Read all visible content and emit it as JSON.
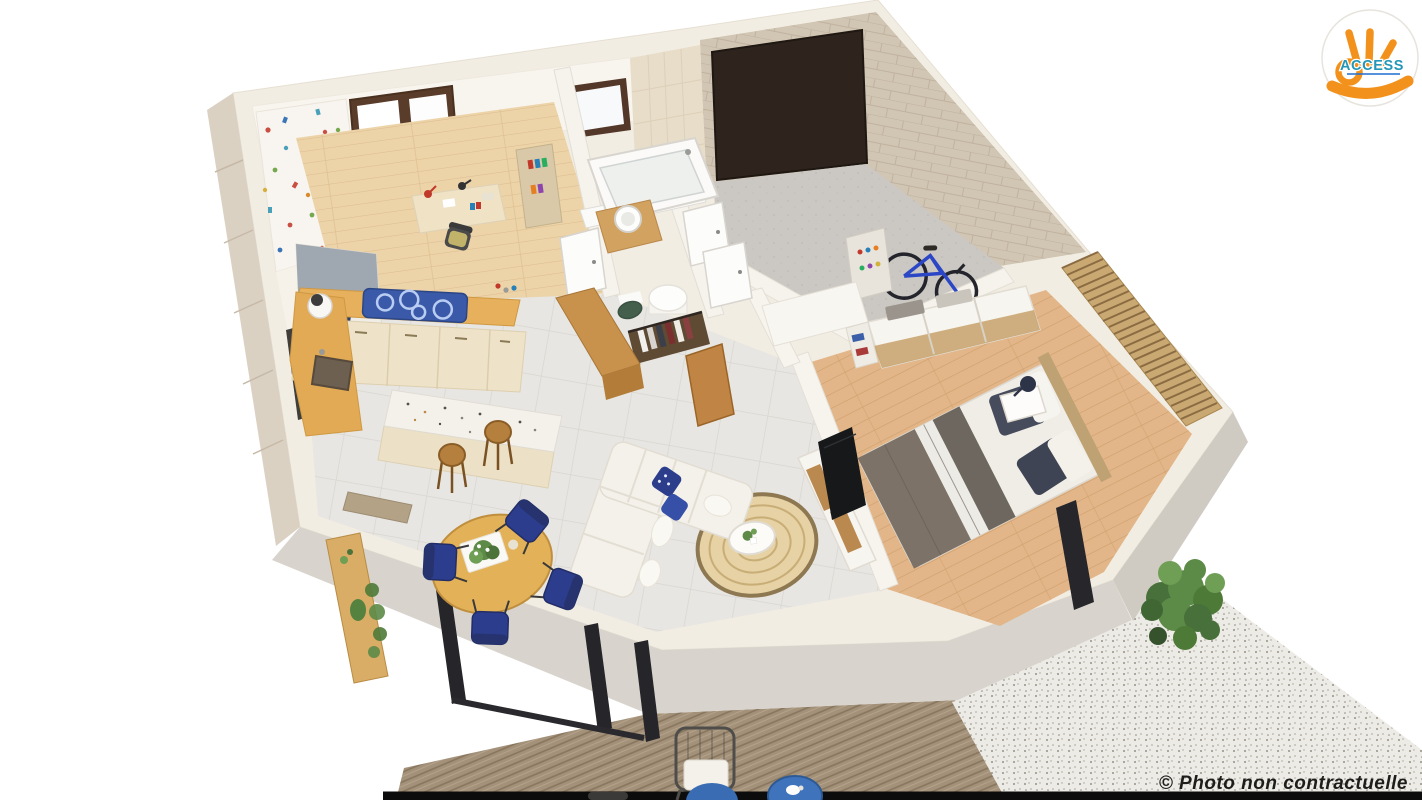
{
  "page": {
    "width": 1422,
    "height": 800,
    "background": "#ffffff"
  },
  "branding": {
    "logo_text": "ACCESS",
    "logo_text_color": "#2397b7",
    "logo_hand_color": "#f2921c",
    "logo_underline_color": "#1e6fd0",
    "logo_circle_fill": "#ffffff",
    "logo_circle_border": "#e7e4de"
  },
  "watermark": {
    "text": "© Photo non contractuelle",
    "color": "#1d1d1b"
  },
  "palette": {
    "wall_cream": "#f2ede3",
    "wall_face_gray": "#d8d4cd",
    "stone_beige": "#d1c5b3",
    "tile_floor": "#e8e6e2",
    "wood_child_floor": "#ecd3a8",
    "wood_master_floor": "#e2b688",
    "kitchen_counter_wood": "#e7b05c",
    "cabinet_cream": "#eee3c9",
    "hob_blue": "#3a59a8",
    "navy_blue": "#2d3d8d",
    "sofa_cream": "#f4f1ea",
    "rug_jute": "#e6d2a4",
    "bed_blanket_taupe": "#7c7268",
    "bed_pillow_navy": "#474c5c",
    "slat_wood": "#c9a872",
    "deck_wood": "#a3917a",
    "gravel": "#edebe6",
    "shrub_green": "#5c8a47",
    "bike_blue": "#2c47c6",
    "garage_door_brown": "#2e241d",
    "tv_black": "#17181a",
    "black_strip": "#0c0c0c"
  },
  "scene": {
    "description": "3D cutaway floor-plan render of a single-storey home seen from above",
    "rooms": [
      "kids-bedroom-office",
      "kitchen",
      "dining-area",
      "living-room",
      "bathroom",
      "wc-dressing",
      "garage",
      "master-bedroom",
      "terrace-deck",
      "gravel-garden"
    ],
    "objects": [
      "confetti-wallpaper",
      "window",
      "single-bed",
      "desk-chair-lamps",
      "book-shelf",
      "hob",
      "sink",
      "terrazzo-island",
      "bar-stools",
      "round-dining-table",
      "navy-chairs",
      "console-shelf",
      "l-shaped-sofa",
      "jute-rug",
      "coffee-table",
      "tv-sideboard",
      "bathtub",
      "vessel-sink",
      "open-wardrobe-clothes",
      "pouf",
      "garage-door",
      "bicycle",
      "storage-rack",
      "double-bed",
      "slatted-headboard-wall",
      "sliding-door-wardrobe",
      "nightstand-lamp",
      "sliding-glass-doors",
      "outdoor-wire-chair",
      "blue-side-tables",
      "shrub"
    ]
  }
}
